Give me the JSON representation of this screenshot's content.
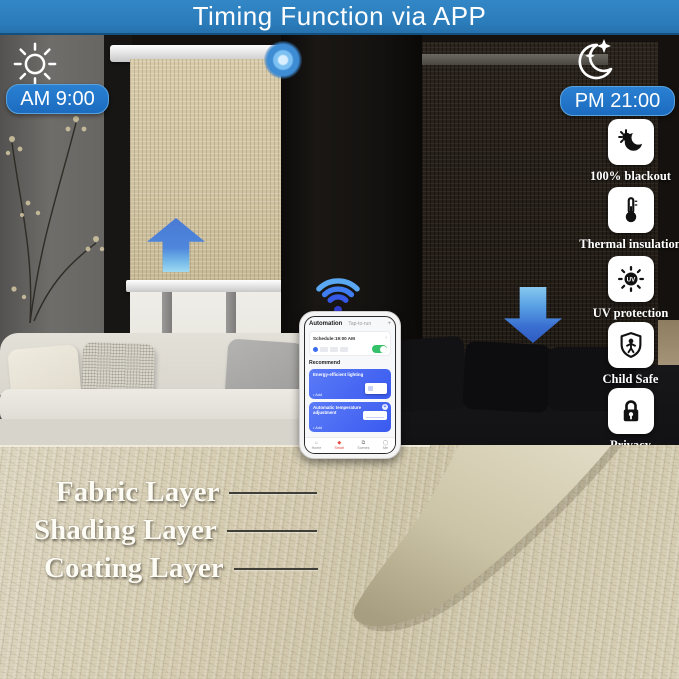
{
  "header": {
    "title": "Timing Function via APP"
  },
  "scene": {
    "day": {
      "time": "AM 9:00"
    },
    "night": {
      "time": "PM 21:00"
    }
  },
  "features": [
    {
      "id": "blackout",
      "label": "100% blackout"
    },
    {
      "id": "thermal-insulation",
      "label": "Thermal insulation"
    },
    {
      "id": "uv-protection",
      "label": "UV protection"
    },
    {
      "id": "child-safe",
      "label": "Child Safe"
    },
    {
      "id": "privacy",
      "label": "Privacy"
    }
  ],
  "phone_app": {
    "tabs": {
      "automation": "Automation",
      "tap_to_run": "Tap-to-run"
    },
    "add_symbol": "+",
    "schedule_item": "Schedule:19:00 AM",
    "section_title": "Recommend",
    "cards": [
      {
        "title": "Energy-efficient lighting",
        "action": "Add"
      },
      {
        "title": "Automatic temperature adjustment",
        "action": "Add"
      }
    ],
    "nav": [
      {
        "label": "Home"
      },
      {
        "label": "Smart"
      },
      {
        "label": "Scenes"
      },
      {
        "label": "Me"
      }
    ]
  },
  "layers": [
    {
      "label": "Fabric Layer"
    },
    {
      "label": "Shading Layer"
    },
    {
      "label": "Coating Layer"
    }
  ],
  "colors": {
    "header_blue": "#2b7cba",
    "pill_blue": "#1c6cc0",
    "arrow_blue": "#3a6fd0",
    "app_card_blue": "#3a5af0",
    "toggle_green": "#35c06a",
    "fabric_beige": "#d6cdb2",
    "blind_day": "#cfc2a0",
    "blind_night": "#231d17"
  }
}
